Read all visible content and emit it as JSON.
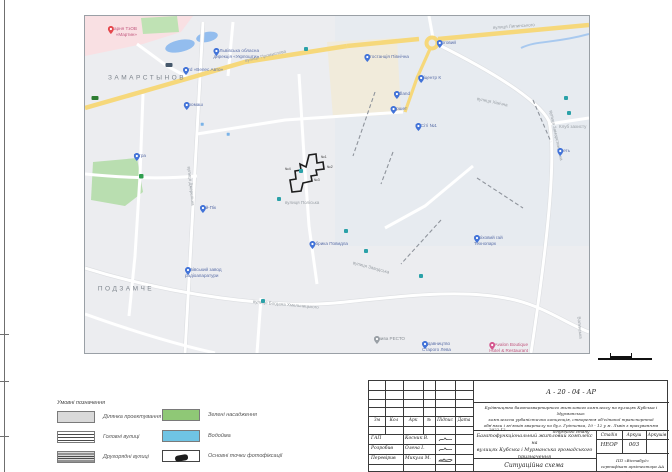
{
  "map": {
    "districts": [
      {
        "text": "ЗАМАРСТЫНОВ",
        "x": 62,
        "y": 62
      },
      {
        "text": "ПОДЗАМЧЕ",
        "x": 41,
        "y": 273
      }
    ],
    "road_labels": [
      {
        "text": "вулиця Промислова",
        "x": 160,
        "y": 42,
        "rot": -13
      },
      {
        "text": "вулиця Липинського",
        "x": 408,
        "y": 9,
        "rot": -4
      },
      {
        "text": "вулиця Замарстинівська",
        "x": 466,
        "y": 92,
        "rot": 78
      },
      {
        "text": "вулиця Богдана Хмельницького",
        "x": 168,
        "y": 283,
        "rot": 5
      },
      {
        "text": "вулиця Джерельна",
        "x": 104,
        "y": 148,
        "rot": 84
      },
      {
        "text": "вулиця Хімічна",
        "x": 392,
        "y": 80,
        "rot": 12
      },
      {
        "text": "вулиця Поліська",
        "x": 200,
        "y": 184,
        "rot": 0
      },
      {
        "text": "Волинська",
        "x": 494,
        "y": 298,
        "rot": 85
      },
      {
        "text": "вулиця Заводська",
        "x": 268,
        "y": 244,
        "rot": 15
      },
      {
        "text": "Клуб захисту",
        "x": 474,
        "y": 108,
        "rot": 0
      }
    ],
    "pois": [
      {
        "x": 52,
        "y": 16,
        "color": "red",
        "side": "left",
        "lines": [
          "Лікарня ТзОВ",
          "«Мартин»"
        ]
      },
      {
        "x": 101,
        "y": 54,
        "color": "blue",
        "side": "right",
        "lines": [
          "Ford «Велес Авто»"
        ]
      },
      {
        "x": 174,
        "y": 38,
        "color": "blue",
        "side": "left",
        "lines": [
          "Львівська обласна",
          "дирекція «Укрпошти»"
        ]
      },
      {
        "x": 118,
        "y": 89,
        "color": "blue",
        "side": "left",
        "lines": [
          "Агромаш"
        ]
      },
      {
        "x": 61,
        "y": 140,
        "color": "blue",
        "side": "left",
        "lines": [
          "Тетра"
        ]
      },
      {
        "x": 131,
        "y": 192,
        "color": "blue",
        "side": "left",
        "lines": [
          "Чай-Пік"
        ]
      },
      {
        "x": 371,
        "y": 27,
        "color": "blue",
        "side": "left",
        "lines": [
          "Торговий"
        ]
      },
      {
        "x": 324,
        "y": 41,
        "color": "blue",
        "side": "left",
        "lines": [
          "Автостанція Північна"
        ]
      },
      {
        "x": 356,
        "y": 62,
        "color": "blue",
        "side": "left",
        "lines": [
          "Епіцентр К"
        ]
      },
      {
        "x": 325,
        "y": 78,
        "color": "blue",
        "side": "left",
        "lines": [
          "Midland"
        ]
      },
      {
        "x": 322,
        "y": 93,
        "color": "blue",
        "side": "left",
        "lines": [
          "Фуршет"
        ]
      },
      {
        "x": 352,
        "y": 110,
        "color": "blue",
        "side": "left",
        "lines": [
          "Ін-Сіті №1"
        ]
      },
      {
        "x": 485,
        "y": 135,
        "color": "blue",
        "side": "left",
        "lines": [
          "Кметь"
        ]
      },
      {
        "x": 103,
        "y": 257,
        "color": "blue",
        "side": "right",
        "lines": [
          "Львівський завод",
          "радіоапаратури"
        ]
      },
      {
        "x": 263,
        "y": 228,
        "color": "blue",
        "side": "left",
        "lines": [
          "Фабрика Повидла"
        ]
      },
      {
        "x": 392,
        "y": 225,
        "color": "blue",
        "side": "right",
        "lines": [
          "Горіховий гай",
          "Технопарк"
        ]
      },
      {
        "x": 320,
        "y": 323,
        "color": "gray",
        "side": "left",
        "lines": [
          "Жнива РЕСТО"
        ]
      },
      {
        "x": 340,
        "y": 331,
        "color": "blue",
        "side": "right",
        "lines": [
          "Видавництво",
          "Старого Лева"
        ]
      },
      {
        "x": 443,
        "y": 332,
        "color": "pink",
        "side": "left",
        "lines": [
          "Avalon Boutique",
          "Hotel & Restaurant"
        ]
      }
    ],
    "transit": [
      [
        221,
        33
      ],
      [
        481,
        82
      ],
      [
        484,
        97
      ],
      [
        216,
        155
      ],
      [
        194,
        183
      ],
      [
        261,
        215
      ],
      [
        281,
        235
      ],
      [
        336,
        260
      ],
      [
        178,
        285
      ]
    ],
    "waterpoints": [
      [
        117,
        108
      ],
      [
        143,
        118
      ]
    ],
    "shields": [
      {
        "x": 10,
        "y": 82,
        "color": "#2e7d32"
      },
      {
        "x": 84,
        "y": 49,
        "color": "#46586b"
      }
    ],
    "site_labels": [
      {
        "text": "№1",
        "x": 236,
        "y": 139
      },
      {
        "text": "№2",
        "x": 242,
        "y": 149
      },
      {
        "text": "№3",
        "x": 229,
        "y": 162
      },
      {
        "text": "№4",
        "x": 200,
        "y": 151
      }
    ]
  },
  "legend": {
    "title": "Умовні позначення",
    "items": [
      {
        "label": "Ділянка проектування"
      },
      {
        "label": "Головні вулиці"
      },
      {
        "label": "Другорядні вулиці"
      },
      {
        "label": "Зелені насадження"
      },
      {
        "label": "Водойма"
      },
      {
        "label": "Основні точки фотофіксації"
      }
    ]
  },
  "stamp": {
    "doc_code": "А - 20 - 04  -  АР",
    "description_lines": [
      "Будівництво багатоквартирного житлового комплексу на вулицях Кубська і Мурманська:",
      "комплексна урбаністична концепція, створення об'єднаної транспортної",
      "обв'язки і зв'язків кварталу по бул. Грінченка, 10 - 12 у м. Львів з врахуванням",
      "існуючого стану"
    ],
    "date_note": "2022.12",
    "project_name_lines": [
      "Багатофункціональний житловий комплекс на",
      "вулицях Кубська і Мурманська громадського",
      "призначення"
    ],
    "sheet_title": "Ситуаційна схема",
    "header": [
      "Зм",
      "Кол",
      "Арк",
      "№",
      "Підпис",
      "Дата"
    ],
    "rows": [
      {
        "role": "ГАП",
        "name": "Косник В."
      },
      {
        "role": "Розробив",
        "name": "Олена І."
      },
      {
        "role": "Перевірив",
        "name": "Микула М."
      }
    ],
    "stage_col": "Стадія",
    "sheet_col": "Аркуш",
    "sheets_col": "Аркушів",
    "stage_value": "НЕОР",
    "sheet_value": "003",
    "sheets_value": "",
    "org_lines": [
      "ПП «Вістабуд»",
      "сертифікат архітектора АА №1907"
    ]
  },
  "colors": {
    "poi_blue": "#4273d8",
    "poi_label_blue": "#5b6fa8",
    "poi_red": "#e5484d",
    "poi_pink": "#d5578f",
    "poi_label_pink": "#c2577e",
    "poi_gray": "#9aa0a6",
    "poi_label_gray": "#8a9096",
    "transit_teal": "#2aa1a8",
    "road_yellow": "#f6d87b",
    "park_green": "#b9deb0",
    "water_blue": "#93bdee",
    "site_outline": "#1d1d1d"
  }
}
